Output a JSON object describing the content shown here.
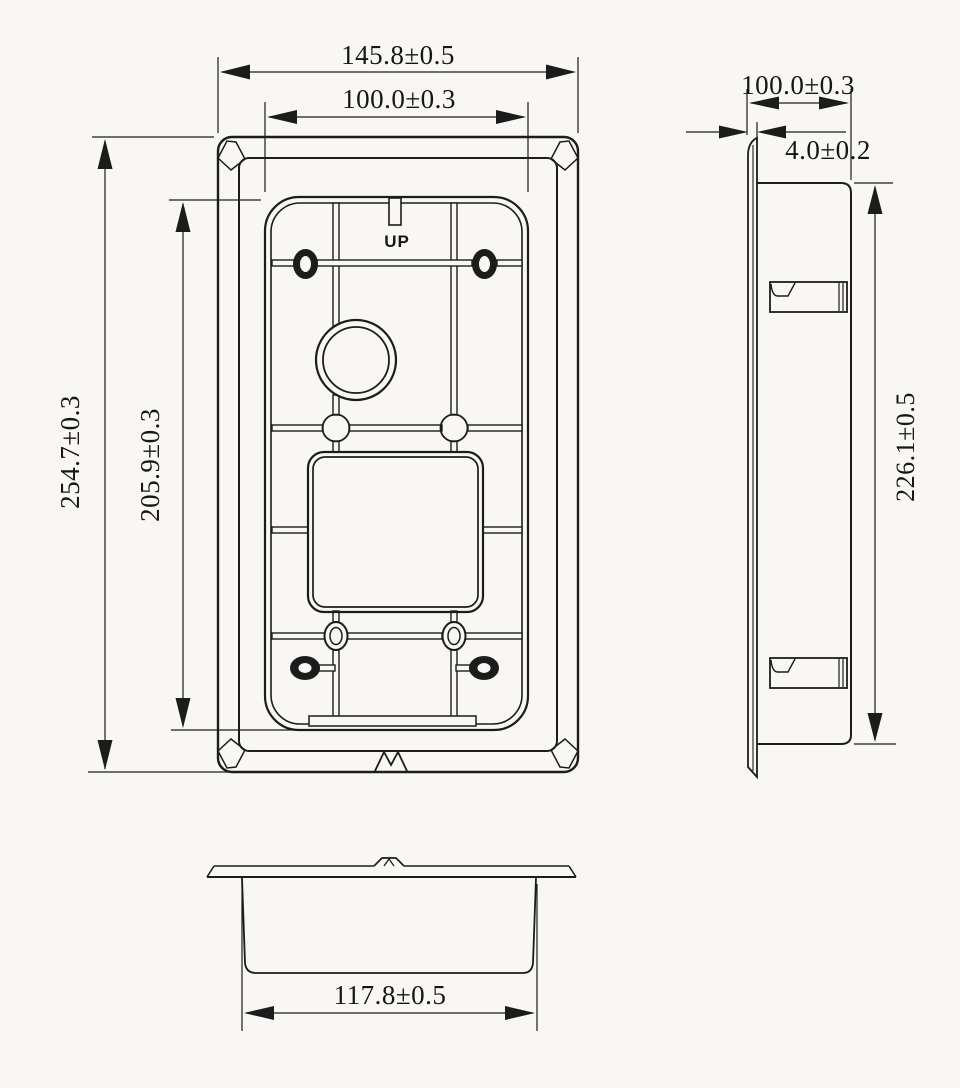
{
  "drawing": {
    "front_view": {
      "outer_width": "145.8±0.5",
      "hole_pitch_width": "100.0±0.3",
      "outer_height": "254.7±0.3",
      "hole_pitch_height": "205.9±0.3",
      "up_marking": "UP"
    },
    "side_view": {
      "overall_depth": "100.0±0.3",
      "flange_thickness": "4.0±0.2",
      "body_height": "226.1±0.5"
    },
    "bottom_view": {
      "body_width": "117.8±0.5"
    },
    "colors": {
      "paper": "#f8f7f4",
      "ink": "#1c1c1c"
    }
  }
}
